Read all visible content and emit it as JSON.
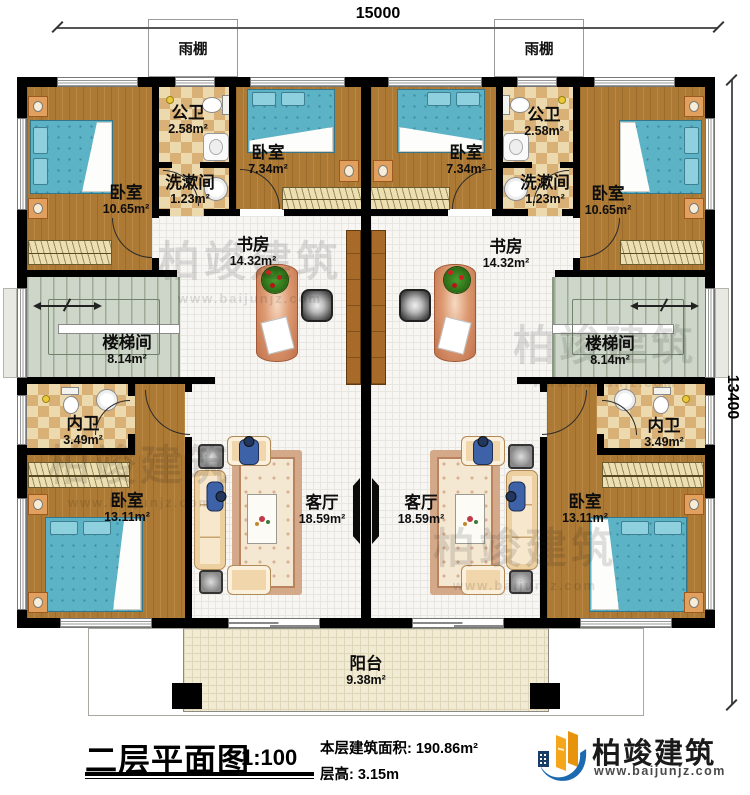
{
  "dimensions": {
    "width_mm": "15000",
    "height_mm": "13400"
  },
  "canopy": {
    "label": "雨棚"
  },
  "rooms": {
    "bedroom_top_left": {
      "name": "卧室",
      "area": "10.65m²"
    },
    "bath_top_left": {
      "name": "公卫",
      "area": "2.58m²"
    },
    "wash_left": {
      "name": "洗漱间",
      "area": "1.23m²"
    },
    "bedroom_mid_left": {
      "name": "卧室",
      "area": "7.34m²"
    },
    "study_left": {
      "name": "书房",
      "area": "14.32m²"
    },
    "stair_left": {
      "name": "楼梯间",
      "area": "8.14m²"
    },
    "bath_inner_left": {
      "name": "内卫",
      "area": "3.49m²"
    },
    "bedroom_bottom_left": {
      "name": "卧室",
      "area": "13.11m²"
    },
    "living_left": {
      "name": "客厅",
      "area": "18.59m²"
    },
    "bedroom_mid_right": {
      "name": "卧室",
      "area": "7.34m²"
    },
    "bath_top_right": {
      "name": "公卫",
      "area": "2.58m²"
    },
    "wash_right": {
      "name": "洗漱间",
      "area": "1.23m²"
    },
    "bedroom_top_right": {
      "name": "卧室",
      "area": "10.65m²"
    },
    "study_right": {
      "name": "书房",
      "area": "14.32m²"
    },
    "stair_right": {
      "name": "楼梯间",
      "area": "8.14m²"
    },
    "bath_inner_right": {
      "name": "内卫",
      "area": "3.49m²"
    },
    "bedroom_bottom_right": {
      "name": "卧室",
      "area": "13.11m²"
    },
    "living_right": {
      "name": "客厅",
      "area": "18.59m²"
    },
    "balcony": {
      "name": "阳台",
      "area": "9.38m²"
    }
  },
  "title_block": {
    "title": "二层平面图",
    "scale": "1:100",
    "floor_area": "本层建筑面积: 190.86m²",
    "floor_height": "层高: 3.15m"
  },
  "brand": {
    "name": "柏竣建筑",
    "website": "www.baijunjz.com"
  },
  "watermark": {
    "name": "柏竣建筑",
    "website": "www.baijunjz.com"
  }
}
